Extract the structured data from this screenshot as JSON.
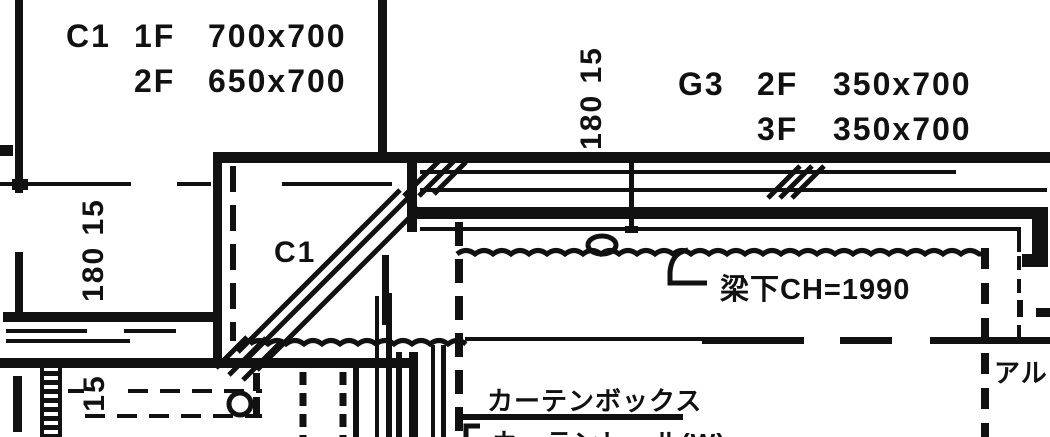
{
  "palette": {
    "ink": "#111111",
    "paper": "#ffffff"
  },
  "schedules": {
    "c1": {
      "tag": "C1",
      "rows": [
        {
          "floor": "1F",
          "size": "700x700"
        },
        {
          "floor": "2F",
          "size": "650x700"
        }
      ]
    },
    "g3": {
      "tag": "G3",
      "rows": [
        {
          "floor": "2F",
          "size": "350x700"
        },
        {
          "floor": "3F",
          "size": "350x700"
        }
      ]
    }
  },
  "dimensions": {
    "left_wall": "180 15",
    "mid_wall": "180 15",
    "sill": "15"
  },
  "annotations": {
    "column_tag": "C1",
    "beam_clearance": "梁下CH=1990",
    "curtain_box": "カーテンボックス",
    "curtain_rail": "カーテンレール(W)",
    "aluminum": "アルミ"
  }
}
